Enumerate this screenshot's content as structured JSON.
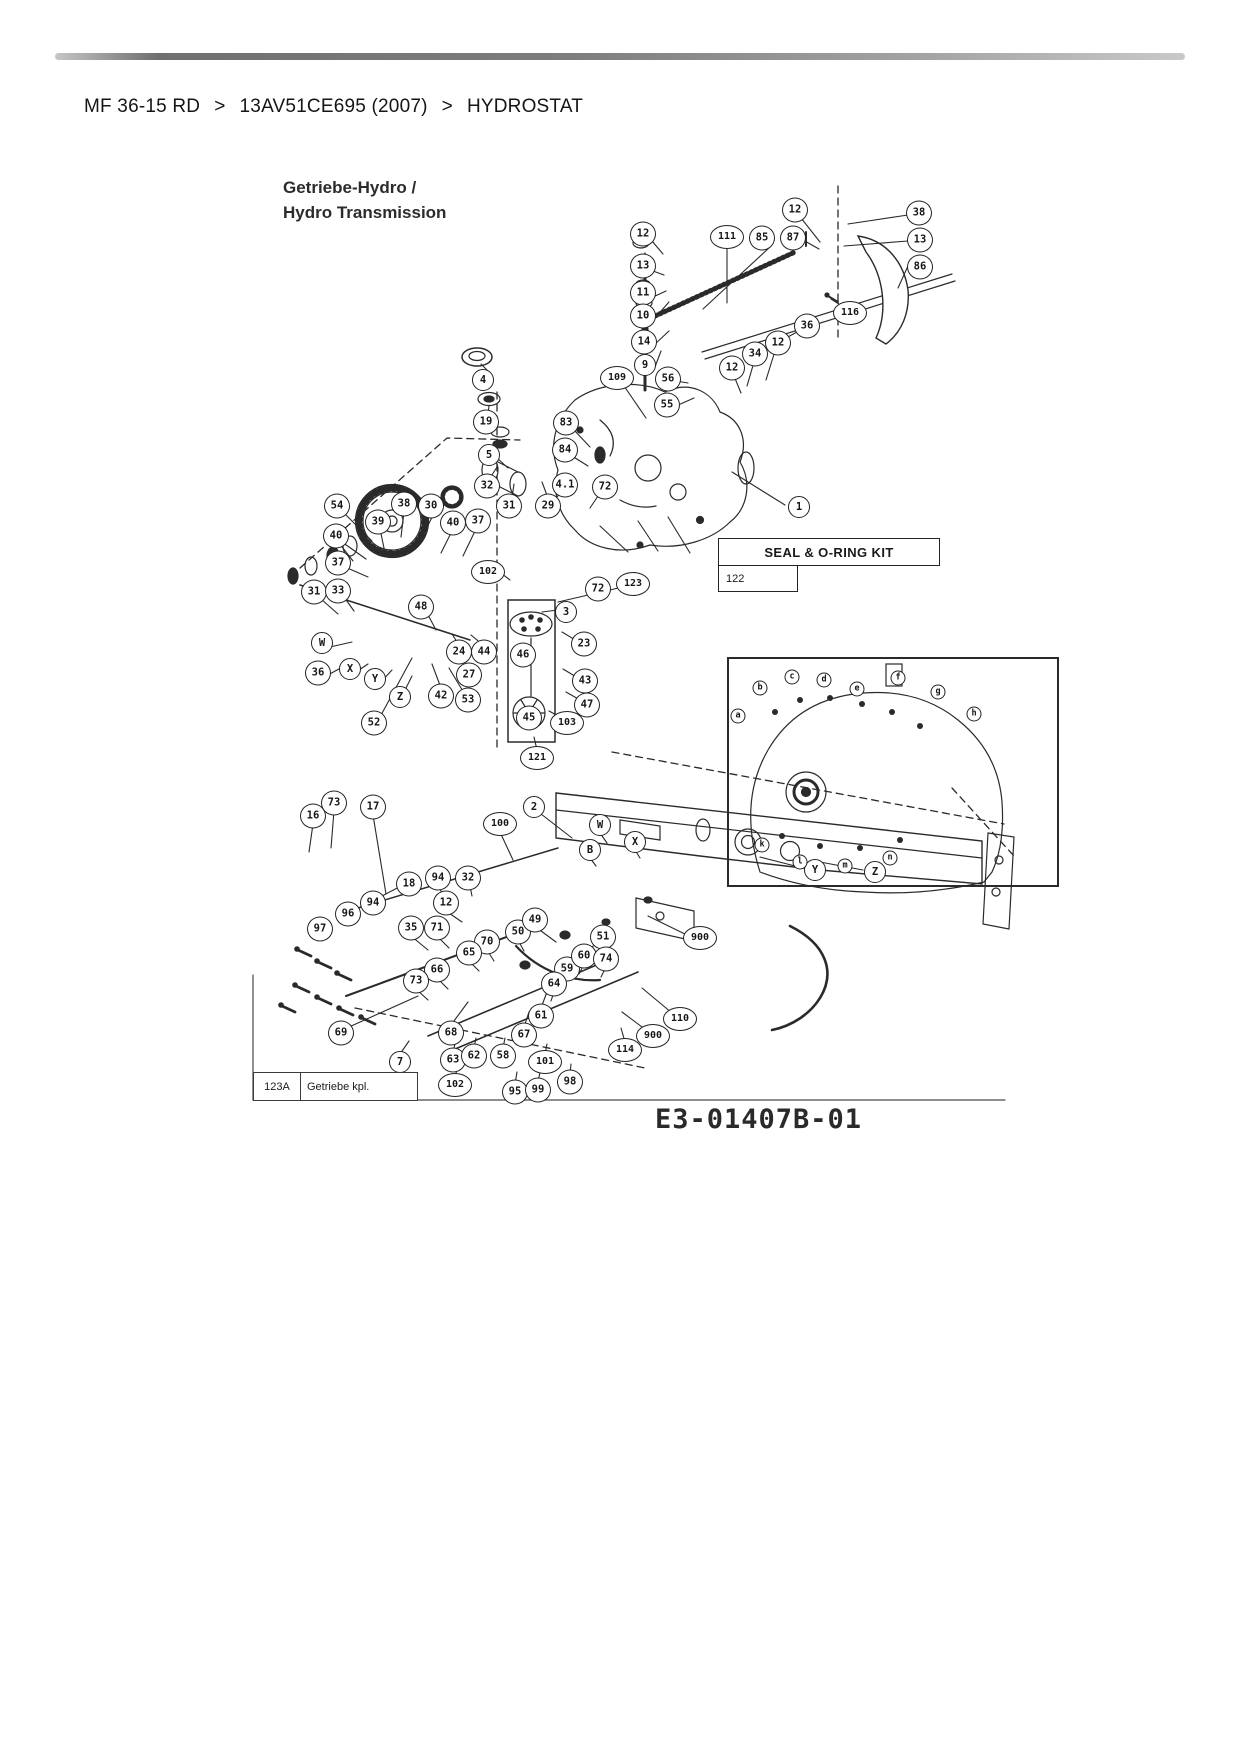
{
  "breadcrumb": {
    "separator": ">",
    "items": [
      {
        "label": "MF 36-15 RD"
      },
      {
        "label": "13AV51CE695 (2007)"
      },
      {
        "label": "HYDROSTAT"
      }
    ]
  },
  "diagram": {
    "title_line1": "Getriebe-Hydro /",
    "title_line2": "Hydro Transmission",
    "seal_kit": {
      "title": "SEAL & O-RING KIT",
      "ref": "122"
    },
    "footer": {
      "ref": "123A",
      "label": "Getriebe kpl."
    },
    "drawing_number": "E3-01407B-01",
    "callouts": [
      {
        "label": "12",
        "x": 643,
        "y": 234
      },
      {
        "label": "13",
        "x": 643,
        "y": 266
      },
      {
        "label": "11",
        "x": 643,
        "y": 293
      },
      {
        "label": "10",
        "x": 643,
        "y": 316
      },
      {
        "label": "14",
        "x": 644,
        "y": 342
      },
      {
        "label": "9",
        "x": 645,
        "y": 365
      },
      {
        "label": "111",
        "x": 727,
        "y": 237
      },
      {
        "label": "85",
        "x": 762,
        "y": 238
      },
      {
        "label": "87",
        "x": 793,
        "y": 238
      },
      {
        "label": "12",
        "x": 795,
        "y": 210
      },
      {
        "label": "38",
        "x": 919,
        "y": 213
      },
      {
        "label": "13",
        "x": 920,
        "y": 240
      },
      {
        "label": "86",
        "x": 920,
        "y": 267
      },
      {
        "label": "116",
        "x": 850,
        "y": 313
      },
      {
        "label": "36",
        "x": 807,
        "y": 326
      },
      {
        "label": "12",
        "x": 778,
        "y": 343
      },
      {
        "label": "34",
        "x": 755,
        "y": 354
      },
      {
        "label": "12",
        "x": 732,
        "y": 368
      },
      {
        "label": "56",
        "x": 668,
        "y": 379
      },
      {
        "label": "55",
        "x": 667,
        "y": 405
      },
      {
        "label": "109",
        "x": 617,
        "y": 378
      },
      {
        "label": "4",
        "x": 483,
        "y": 380
      },
      {
        "label": "19",
        "x": 486,
        "y": 422
      },
      {
        "label": "5",
        "x": 489,
        "y": 455
      },
      {
        "label": "83",
        "x": 566,
        "y": 423
      },
      {
        "label": "84",
        "x": 565,
        "y": 450
      },
      {
        "label": "32",
        "x": 487,
        "y": 486
      },
      {
        "label": "31",
        "x": 509,
        "y": 506
      },
      {
        "label": "29",
        "x": 548,
        "y": 506
      },
      {
        "label": "4.1",
        "x": 565,
        "y": 485
      },
      {
        "label": "72",
        "x": 605,
        "y": 487
      },
      {
        "label": "30",
        "x": 431,
        "y": 506
      },
      {
        "label": "38",
        "x": 404,
        "y": 504
      },
      {
        "label": "39",
        "x": 378,
        "y": 522
      },
      {
        "label": "40",
        "x": 453,
        "y": 523
      },
      {
        "label": "37",
        "x": 478,
        "y": 521
      },
      {
        "label": "54",
        "x": 337,
        "y": 506
      },
      {
        "label": "40",
        "x": 336,
        "y": 536
      },
      {
        "label": "37",
        "x": 338,
        "y": 563
      },
      {
        "label": "102",
        "x": 488,
        "y": 572
      },
      {
        "label": "1",
        "x": 799,
        "y": 507
      },
      {
        "label": "31",
        "x": 314,
        "y": 592
      },
      {
        "label": "33",
        "x": 338,
        "y": 591
      },
      {
        "label": "W",
        "x": 322,
        "y": 643
      },
      {
        "label": "36",
        "x": 318,
        "y": 673
      },
      {
        "label": "X",
        "x": 350,
        "y": 669
      },
      {
        "label": "Y",
        "x": 375,
        "y": 679
      },
      {
        "label": "Z",
        "x": 400,
        "y": 697
      },
      {
        "label": "48",
        "x": 421,
        "y": 607
      },
      {
        "label": "24",
        "x": 459,
        "y": 652
      },
      {
        "label": "44",
        "x": 484,
        "y": 652
      },
      {
        "label": "27",
        "x": 469,
        "y": 675
      },
      {
        "label": "42",
        "x": 441,
        "y": 696
      },
      {
        "label": "53",
        "x": 468,
        "y": 700
      },
      {
        "label": "52",
        "x": 374,
        "y": 723
      },
      {
        "label": "3",
        "x": 566,
        "y": 612
      },
      {
        "label": "72",
        "x": 598,
        "y": 589
      },
      {
        "label": "123",
        "x": 633,
        "y": 584
      },
      {
        "label": "23",
        "x": 584,
        "y": 644
      },
      {
        "label": "43",
        "x": 585,
        "y": 681
      },
      {
        "label": "47",
        "x": 587,
        "y": 705
      },
      {
        "label": "46",
        "x": 523,
        "y": 655
      },
      {
        "label": "45",
        "x": 529,
        "y": 718
      },
      {
        "label": "103",
        "x": 567,
        "y": 723
      },
      {
        "label": "121",
        "x": 537,
        "y": 758
      },
      {
        "label": "16",
        "x": 313,
        "y": 816
      },
      {
        "label": "73",
        "x": 334,
        "y": 803
      },
      {
        "label": "17",
        "x": 373,
        "y": 807
      },
      {
        "label": "100",
        "x": 500,
        "y": 824
      },
      {
        "label": "2",
        "x": 534,
        "y": 807
      },
      {
        "label": "18",
        "x": 409,
        "y": 884
      },
      {
        "label": "94",
        "x": 438,
        "y": 878
      },
      {
        "label": "32",
        "x": 468,
        "y": 878
      },
      {
        "label": "12",
        "x": 446,
        "y": 903
      },
      {
        "label": "94",
        "x": 373,
        "y": 903
      },
      {
        "label": "96",
        "x": 348,
        "y": 914
      },
      {
        "label": "97",
        "x": 320,
        "y": 929
      },
      {
        "label": "35",
        "x": 411,
        "y": 928
      },
      {
        "label": "71",
        "x": 437,
        "y": 928
      },
      {
        "label": "70",
        "x": 487,
        "y": 942
      },
      {
        "label": "65",
        "x": 469,
        "y": 953
      },
      {
        "label": "66",
        "x": 437,
        "y": 970
      },
      {
        "label": "73",
        "x": 416,
        "y": 981
      },
      {
        "label": "50",
        "x": 518,
        "y": 932
      },
      {
        "label": "49",
        "x": 535,
        "y": 920
      },
      {
        "label": "51",
        "x": 603,
        "y": 937
      },
      {
        "label": "59",
        "x": 567,
        "y": 969
      },
      {
        "label": "60",
        "x": 584,
        "y": 956
      },
      {
        "label": "64",
        "x": 554,
        "y": 984
      },
      {
        "label": "74",
        "x": 606,
        "y": 959
      },
      {
        "label": "61",
        "x": 541,
        "y": 1016
      },
      {
        "label": "69",
        "x": 341,
        "y": 1033
      },
      {
        "label": "68",
        "x": 451,
        "y": 1033
      },
      {
        "label": "7",
        "x": 400,
        "y": 1062
      },
      {
        "label": "63",
        "x": 453,
        "y": 1060
      },
      {
        "label": "62",
        "x": 474,
        "y": 1056
      },
      {
        "label": "58",
        "x": 503,
        "y": 1056
      },
      {
        "label": "67",
        "x": 524,
        "y": 1035
      },
      {
        "label": "102",
        "x": 455,
        "y": 1085
      },
      {
        "label": "95",
        "x": 515,
        "y": 1092
      },
      {
        "label": "99",
        "x": 538,
        "y": 1090
      },
      {
        "label": "101",
        "x": 545,
        "y": 1062
      },
      {
        "label": "98",
        "x": 570,
        "y": 1082
      },
      {
        "label": "114",
        "x": 625,
        "y": 1050
      },
      {
        "label": "110",
        "x": 680,
        "y": 1019
      },
      {
        "label": "900",
        "x": 700,
        "y": 938
      },
      {
        "label": "900",
        "x": 653,
        "y": 1036
      },
      {
        "label": "W",
        "x": 600,
        "y": 825
      },
      {
        "label": "X",
        "x": 635,
        "y": 842
      },
      {
        "label": "B",
        "x": 590,
        "y": 850
      },
      {
        "label": "Y",
        "x": 815,
        "y": 870
      },
      {
        "label": "Z",
        "x": 875,
        "y": 872
      }
    ],
    "inset_markers": [
      {
        "label": "a",
        "x": 738,
        "y": 716
      },
      {
        "label": "b",
        "x": 760,
        "y": 688
      },
      {
        "label": "c",
        "x": 792,
        "y": 677
      },
      {
        "label": "d",
        "x": 824,
        "y": 680
      },
      {
        "label": "e",
        "x": 857,
        "y": 689
      },
      {
        "label": "f",
        "x": 898,
        "y": 678
      },
      {
        "label": "g",
        "x": 938,
        "y": 692
      },
      {
        "label": "h",
        "x": 974,
        "y": 714
      },
      {
        "label": "k",
        "x": 762,
        "y": 845
      },
      {
        "label": "l",
        "x": 800,
        "y": 862
      },
      {
        "label": "m",
        "x": 845,
        "y": 866
      },
      {
        "label": "n",
        "x": 890,
        "y": 858
      }
    ]
  }
}
